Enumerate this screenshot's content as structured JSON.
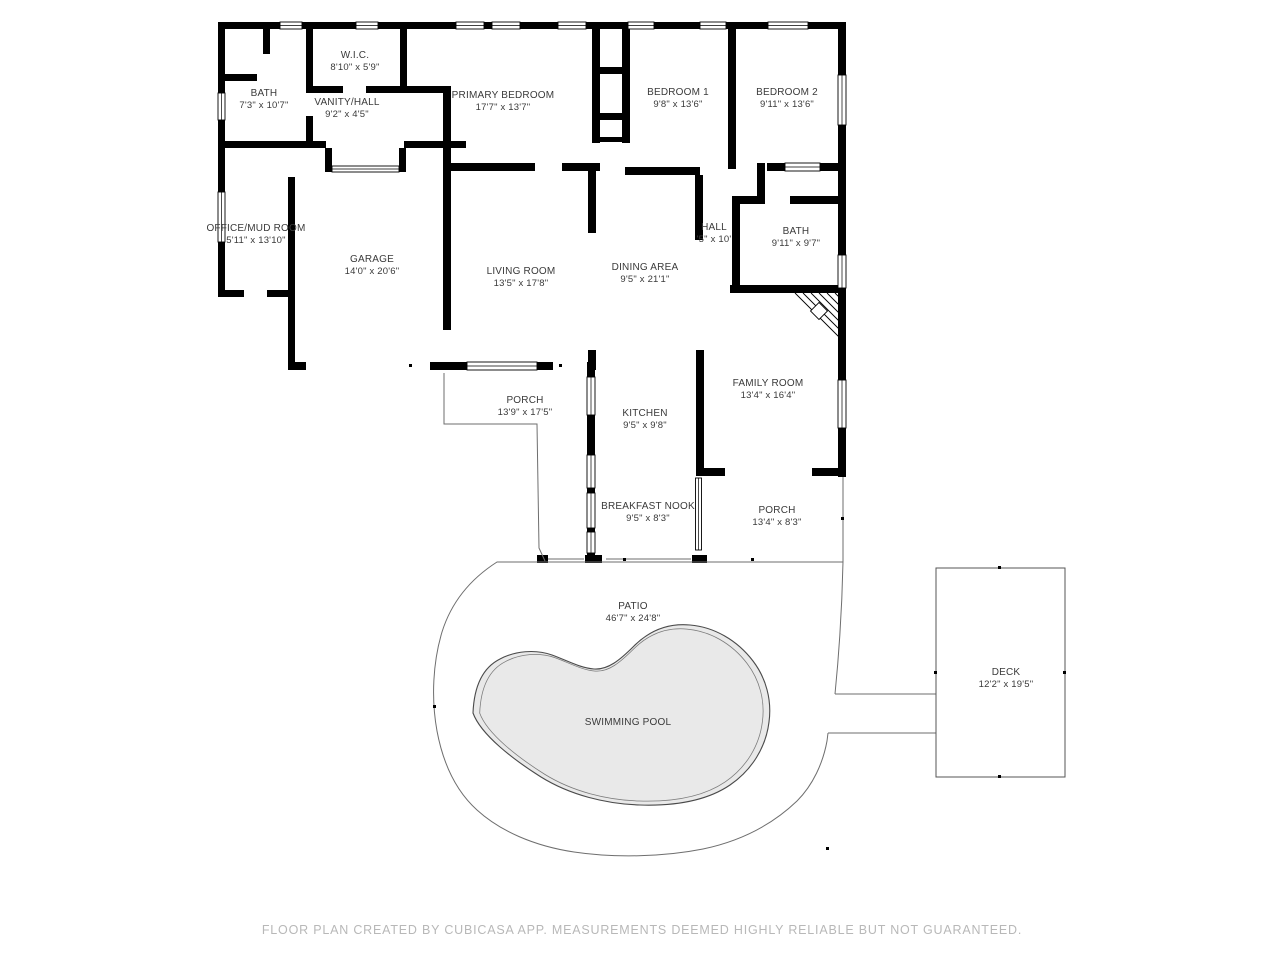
{
  "footer": "FLOOR PLAN CREATED BY CUBICASA APP. MEASUREMENTS DEEMED HIGHLY RELIABLE BUT NOT GUARANTEED.",
  "colors": {
    "wall": "#000000",
    "pool_fill": "#e9e9e9",
    "thin_outline": "#6e6e6e",
    "label_text": "#3a3a3a",
    "footer_text": "#b8b8b8",
    "background": "#ffffff"
  },
  "rooms": [
    {
      "id": "bath-1",
      "name": "BATH",
      "dims": "7'3\" x 10'7\"",
      "cx": 264,
      "cy": 96
    },
    {
      "id": "wic",
      "name": "W.I.C.",
      "dims": "8'10\" x 5'9\"",
      "cx": 355,
      "cy": 58
    },
    {
      "id": "vanity-hall",
      "name": "VANITY/HALL",
      "dims": "9'2\" x 4'5\"",
      "cx": 347,
      "cy": 105
    },
    {
      "id": "primary-bedroom",
      "name": "PRIMARY BEDROOM",
      "dims": "17'7\" x 13'7\"",
      "cx": 503,
      "cy": 98
    },
    {
      "id": "bedroom-1",
      "name": "BEDROOM 1",
      "dims": "9'8\" x 13'6\"",
      "cx": 678,
      "cy": 95
    },
    {
      "id": "bedroom-2",
      "name": "BEDROOM 2",
      "dims": "9'11\" x 13'6\"",
      "cx": 787,
      "cy": 95
    },
    {
      "id": "office-mud-room",
      "name": "OFFICE/MUD ROOM",
      "dims": "5'11\" x 13'10\"",
      "cx": 256,
      "cy": 231
    },
    {
      "id": "garage",
      "name": "GARAGE",
      "dims": "14'0\" x 20'6\"",
      "cx": 372,
      "cy": 262
    },
    {
      "id": "living-room",
      "name": "LIVING ROOM",
      "dims": "13'5\" x 17'8\"",
      "cx": 521,
      "cy": 274
    },
    {
      "id": "dining-area",
      "name": "DINING AREA",
      "dims": "9'5\" x 21'1\"",
      "cx": 645,
      "cy": 270
    },
    {
      "id": "hall",
      "name": "HALL",
      "dims": "'5\" x 10'",
      "cx": 714,
      "cy": 230
    },
    {
      "id": "bath-2",
      "name": "BATH",
      "dims": "9'11\" x 9'7\"",
      "cx": 796,
      "cy": 234
    },
    {
      "id": "family-room",
      "name": "FAMILY ROOM",
      "dims": "13'4\" x 16'4\"",
      "cx": 768,
      "cy": 386
    },
    {
      "id": "porch-1",
      "name": "PORCH",
      "dims": "13'9\" x 17'5\"",
      "cx": 525,
      "cy": 403
    },
    {
      "id": "kitchen",
      "name": "KITCHEN",
      "dims": "9'5\" x 9'8\"",
      "cx": 645,
      "cy": 416
    },
    {
      "id": "breakfast-nook",
      "name": "BREAKFAST NOOK",
      "dims": "9'5\" x 8'3\"",
      "cx": 648,
      "cy": 509
    },
    {
      "id": "porch-2",
      "name": "PORCH",
      "dims": "13'4\" x 8'3\"",
      "cx": 777,
      "cy": 513
    },
    {
      "id": "patio",
      "name": "PATIO",
      "dims": "46'7\" x 24'8\"",
      "cx": 633,
      "cy": 609
    },
    {
      "id": "swimming-pool",
      "name": "SWIMMING POOL",
      "dims": "",
      "cx": 628,
      "cy": 725
    },
    {
      "id": "deck",
      "name": "DECK",
      "dims": "12'2\" x 19'5\"",
      "cx": 1006,
      "cy": 675
    }
  ]
}
